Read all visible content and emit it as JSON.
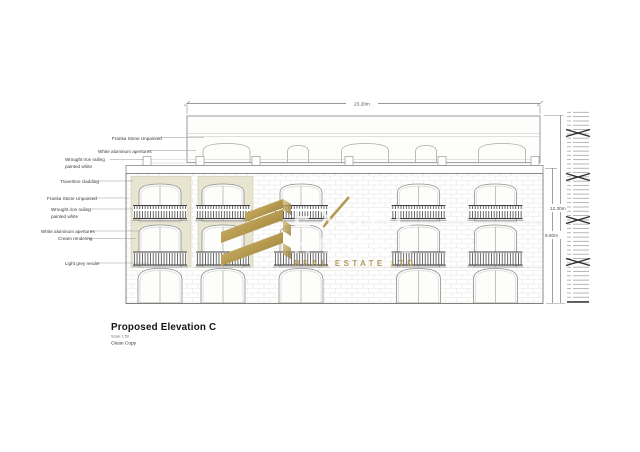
{
  "drawing": {
    "title": "Proposed Elevation C",
    "scale_note": "Scale 1:50",
    "copy_note": "Clean Copy"
  },
  "dimensions": {
    "top_width": "23.20m",
    "total_height": "12.30m",
    "facade_height": "8.90m"
  },
  "annotations": [
    {
      "line1": "Franka Stone Unpainted"
    },
    {
      "line1": "White aluminum apertures"
    },
    {
      "line1": "Wrought iron railing",
      "line2": "painted white"
    },
    {
      "line1": "Travertine cladding"
    },
    {
      "line1": "Franka Stone Unpainted"
    },
    {
      "line1": "Wrought iron railing",
      "line2": "painted white"
    },
    {
      "line1": "White aluminum apertures"
    },
    {
      "line1": "Cream rendering"
    },
    {
      "line1": "Light grey render"
    }
  ],
  "watermark": {
    "brand": "EXCEL",
    "brand_line2": "HOMES",
    "tagline": "REAL ESTATE LTD",
    "gold": "#b3974d",
    "gold_light": "#d7bd74",
    "gold_dark": "#8a7338"
  },
  "colors": {
    "cream_render": "#e7e4d0",
    "line_gray": "#8d8d8b",
    "railing_dark": "#4f4f4f",
    "background": "#ffffff"
  }
}
